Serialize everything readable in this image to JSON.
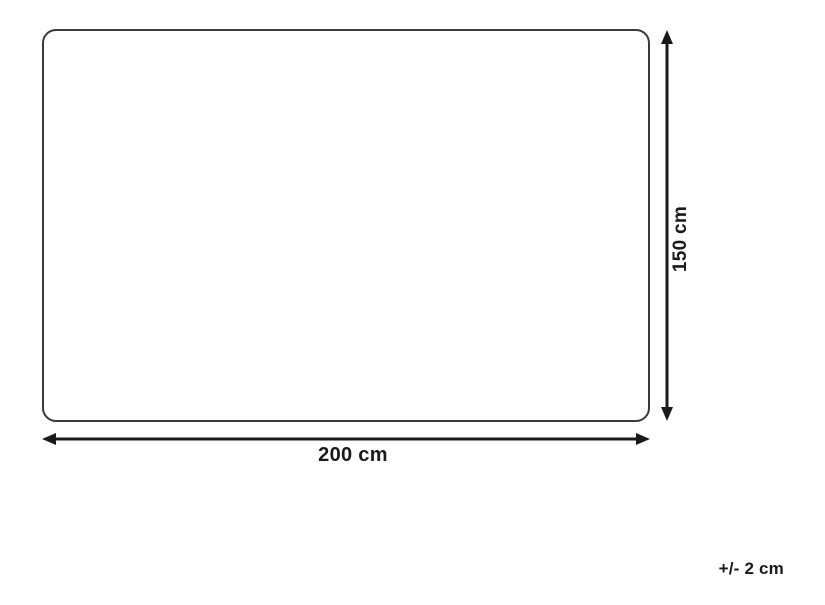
{
  "diagram": {
    "type": "product-dimensions",
    "width_label": "200 cm",
    "height_label": "150 cm",
    "tolerance_label": "+/- 2 cm"
  },
  "icons": {
    "arrow_up": "arrow-up-icon",
    "arrow_down": "arrow-down-icon",
    "arrow_left": "arrow-left-icon",
    "arrow_right": "arrow-right-icon"
  },
  "colors": {
    "background": "#ffffff",
    "outline": "#3a3a3a",
    "dimension": "#1a1a1a",
    "text": "#1a1a1a"
  }
}
